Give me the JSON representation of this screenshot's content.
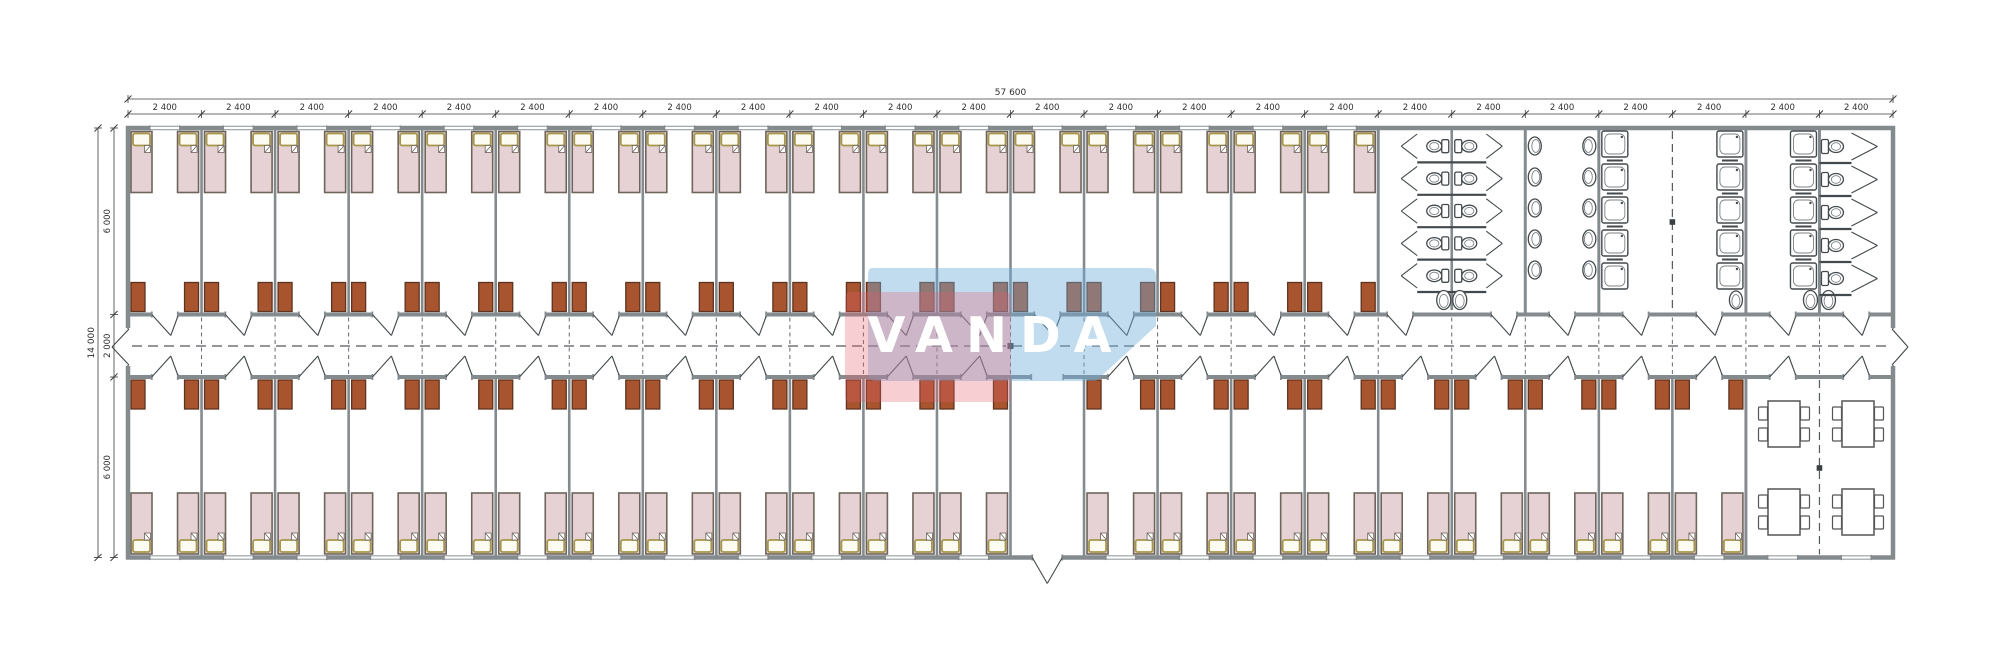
{
  "drawing": {
    "type": "modular dormitory floor plan",
    "watermark_text": "VANDA",
    "dimensions": {
      "top_total_label": "57 600",
      "top_bay_label": "2 400",
      "top_bay_count": 24,
      "left_total_label": "14 000",
      "left_segment_labels": [
        "6 000",
        "2 000",
        "6 000"
      ]
    },
    "layout": {
      "bay_count": 24,
      "top_bedroom_bay_count": 17,
      "bottom_bedroom_bay_count": 21,
      "entrance_bay_index": 12,
      "dining_bay_count": 2,
      "beds_per_room": 2,
      "wardrobes_per_room": 2,
      "wc_stall_rows_back_to_back": 5,
      "wc_stall_rows_single": 5,
      "washbasin_columns": 2,
      "washbasins_per_column": 5,
      "shower_tray_columns": 3,
      "shower_trays_per_column": 5,
      "dining_tables": 4,
      "chairs_per_table": 4
    },
    "colors": {
      "wall": "#848b8f",
      "bed_fill": "#e6d2d4",
      "bed_border": "#6e655b",
      "pillow_border": "#a6974b",
      "pillow_fill": "#fcfbf2",
      "wardrobe_fill": "#a7542f",
      "wardrobe_border": "#5e3420",
      "fixture": "#43494c",
      "fixture_light": "#7c8285",
      "dash": "#53585c",
      "dim_line": "#3c3c3c",
      "dim_text": "#2f2f2f",
      "window_line": "#979ea2",
      "logo_pink": "rgba(228,96,110,0.30)",
      "logo_blue": "rgba(110,172,218,0.42)",
      "logo_text": "#ffffff"
    }
  }
}
